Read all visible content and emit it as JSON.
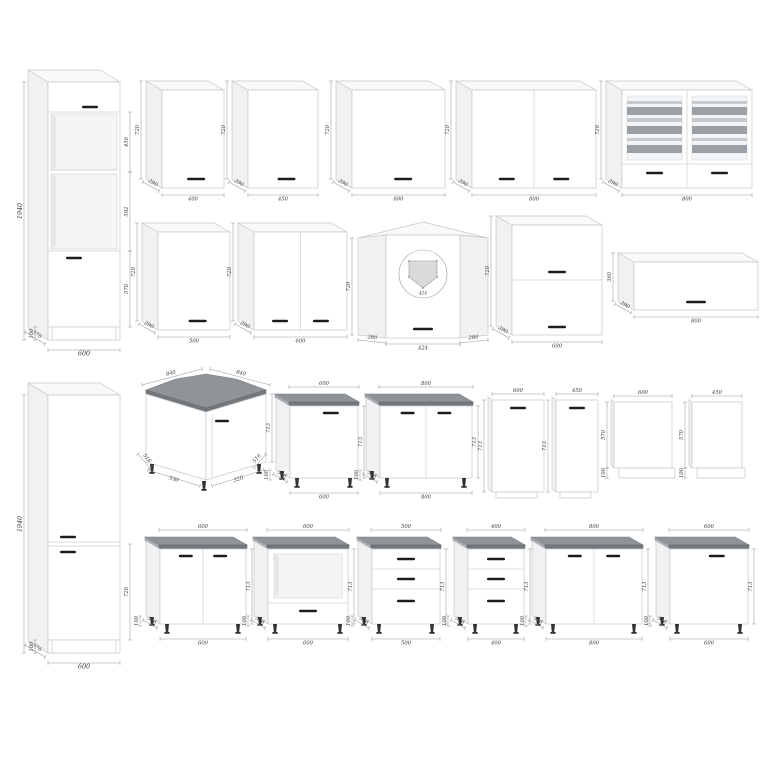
{
  "page": {
    "background": "#ffffff"
  },
  "colors": {
    "outline": "#c5c8ca",
    "dimension_line": "#9a9a9a",
    "dimension_text": "#3b3b3b",
    "handle": "#1c1c1c",
    "worktop_top": "#8f9499",
    "worktop_edge": "#73787c",
    "glass_stripe_dark": "#9aa0a5",
    "glass_stripe_light": "#c6cacc"
  },
  "cabinets": [
    {
      "id": "tall-oven-housing",
      "kind": "tallOven",
      "dims": {
        "height": "1940",
        "upper_niche": "450",
        "oven_niche": "592",
        "lower_door": "570",
        "plinth": "100",
        "depth": "576",
        "width": "600"
      }
    },
    {
      "id": "wall-cabinet-400",
      "kind": "wall",
      "dims": {
        "width": "400",
        "height": "720",
        "depth": "290"
      }
    },
    {
      "id": "wall-cabinet-450",
      "kind": "wall",
      "dims": {
        "width": "450",
        "height": "720",
        "depth": "290"
      }
    },
    {
      "id": "wall-cabinet-600",
      "kind": "wall",
      "dims": {
        "width": "600",
        "height": "720",
        "depth": "290"
      }
    },
    {
      "id": "wall-cabinet-800",
      "kind": "wall",
      "dims": {
        "width": "800",
        "height": "720",
        "depth": "290"
      }
    },
    {
      "id": "wall-glass-cabinet-800",
      "kind": "wallGlass",
      "dims": {
        "width": "800",
        "height": "720",
        "depth": "290"
      }
    },
    {
      "id": "wall-cabinet-500",
      "kind": "wall",
      "dims": {
        "width": "500",
        "height": "720",
        "depth": "290"
      }
    },
    {
      "id": "wall-cabinet-600-two-door",
      "kind": "wall",
      "dims": {
        "width": "600",
        "height": "720",
        "depth": "290"
      }
    },
    {
      "id": "wall-corner-cabinet",
      "kind": "wallCorner",
      "dims": {
        "height": "720",
        "front_width": "424",
        "side_width": "280",
        "plan_front": "424"
      }
    },
    {
      "id": "wall-flap-cabinet-600",
      "kind": "wallFlap2",
      "dims": {
        "width": "600",
        "height": "720",
        "depth": "290"
      }
    },
    {
      "id": "wall-flap-cabinet-800",
      "kind": "wallFlap1",
      "dims": {
        "width": "800",
        "height": "360",
        "depth": "290"
      }
    },
    {
      "id": "tall-cabinet-two-door",
      "kind": "tallFridge",
      "dims": {
        "height": "1940",
        "lower_door": "720",
        "plinth": "100",
        "depth": "576",
        "width": "600"
      }
    },
    {
      "id": "base-corner-cabinet",
      "kind": "baseCorner",
      "dims": {
        "top_left": "840",
        "top_right": "840",
        "height": "713",
        "bottom_left": "516",
        "front_left": "330",
        "front_right": "320",
        "bottom_right": "516"
      }
    },
    {
      "id": "base-cabinet-600-one-door",
      "kind": "base",
      "dims": {
        "width": "600",
        "height": "713",
        "depth": "516",
        "legs": "100"
      }
    },
    {
      "id": "base-cabinet-800-two-door",
      "kind": "base",
      "dims": {
        "width": "800",
        "height": "713",
        "depth": "516",
        "legs": "100"
      }
    },
    {
      "id": "dishwasher-panel-600",
      "kind": "dwPanel",
      "dims": {
        "width": "600",
        "height": "713"
      }
    },
    {
      "id": "dishwasher-panel-450",
      "kind": "dwPanel",
      "dims": {
        "width": "450",
        "height": "713"
      }
    },
    {
      "id": "side-panel-600",
      "kind": "plainPanel",
      "dims": {
        "width": "600",
        "height": "570",
        "bottom": "100"
      }
    },
    {
      "id": "side-panel-450",
      "kind": "plainPanel",
      "dims": {
        "width": "450",
        "height": "570",
        "bottom": "100"
      }
    },
    {
      "id": "base-cabinet-600-two-door",
      "kind": "base",
      "dims": {
        "width": "600",
        "height": "713",
        "depth": "516",
        "legs": "100"
      }
    },
    {
      "id": "base-oven-housing-600",
      "kind": "base",
      "dims": {
        "width": "600",
        "height": "713",
        "depth": "516",
        "legs": "100"
      }
    },
    {
      "id": "base-drawer-cabinet-500",
      "kind": "base",
      "dims": {
        "width": "500",
        "height": "713",
        "depth": "516",
        "legs": "100"
      }
    },
    {
      "id": "base-drawer-cabinet-400",
      "kind": "base",
      "dims": {
        "width": "400",
        "height": "713",
        "depth": "516",
        "legs": "100"
      }
    },
    {
      "id": "base-cabinet-800-two-door-b",
      "kind": "base",
      "dims": {
        "width": "800",
        "height": "713",
        "depth": "516",
        "legs": "100"
      }
    },
    {
      "id": "base-cabinet-600-one-door-b",
      "kind": "base",
      "dims": {
        "width": "600",
        "height": "713",
        "depth": "516",
        "legs": "100"
      }
    }
  ]
}
